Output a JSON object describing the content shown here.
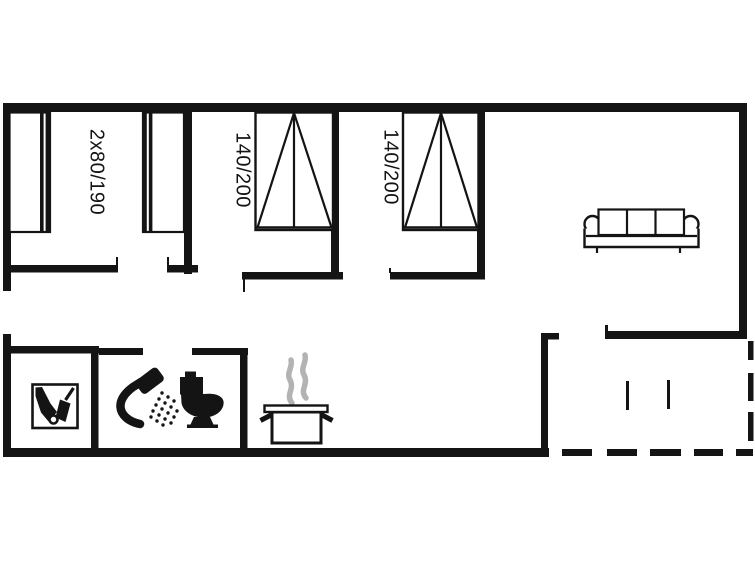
{
  "document": {
    "type": "floor-plan",
    "name": "Holiday home floor plan"
  },
  "colors": {
    "line": "#141414",
    "background": "#ffffff",
    "steam": "#b3b3b3"
  },
  "rooms": {
    "bedroom1": {
      "bed_label": "2x80/190"
    },
    "bedroom2": {
      "bed_label": "140/200"
    },
    "bedroom3": {
      "bed_label": "140/200"
    }
  },
  "icons": [
    "vacuum-cleaner-icon",
    "shower-icon",
    "toilet-icon",
    "cooking-pot-icon",
    "steam-icon",
    "sofa-icon",
    "single-bed-icon",
    "double-bed-icon",
    "terrace-dashed-boundary"
  ]
}
